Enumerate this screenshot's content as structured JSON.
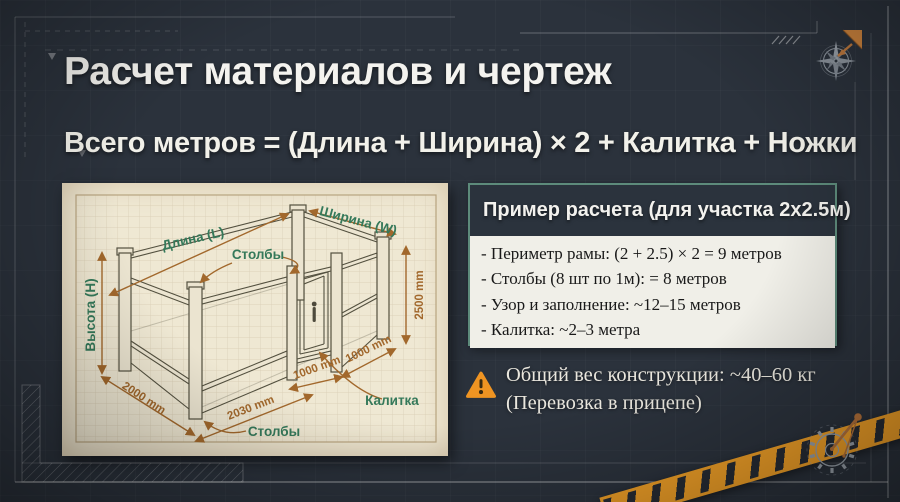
{
  "slide": {
    "title": "Расчет материалов и чертеж",
    "formula": "Всего метров = (Длина + Ширина) × 2 + Калитка + Ножки"
  },
  "drawing": {
    "labels": {
      "length": "Длина (L)",
      "width": "Ширина (W)",
      "height": "Высота (H)",
      "posts_top": "Столбы",
      "posts_bottom": "Столбы",
      "gate": "Калитка"
    },
    "dimensions": {
      "height_right": "2500 mm",
      "depth_left": "2000 mm",
      "length_bottom": "2030 mm",
      "gate_a": "1000 mm",
      "gate_b": "1000 mm"
    }
  },
  "example_box": {
    "header": "Пример расчета (для участка 2х2.5м)",
    "items": [
      "- Периметр рамы: (2 + 2.5) × 2 = 9 метров",
      "- Столбы (8 шт по 1м): = 8 метров",
      "- Узор и заполнение: ~12–15 метров",
      "- Калитка: ~2–3 метра"
    ]
  },
  "warning": {
    "line1": "Общий вес конструкции: ~40–60 кг",
    "line2": "(Перевозка в прицепе)"
  },
  "icons": {
    "compass": "compass-rose-icon",
    "gear": "gear-compass-icon",
    "warning": "warning-triangle-icon"
  },
  "colors": {
    "background": "#2b323c",
    "accent_orange": "#efa32a",
    "teal_border": "#5d8b7b",
    "paper": "#efe8d3",
    "label_green": "#35795a",
    "dimension_brown": "#a2682c"
  }
}
